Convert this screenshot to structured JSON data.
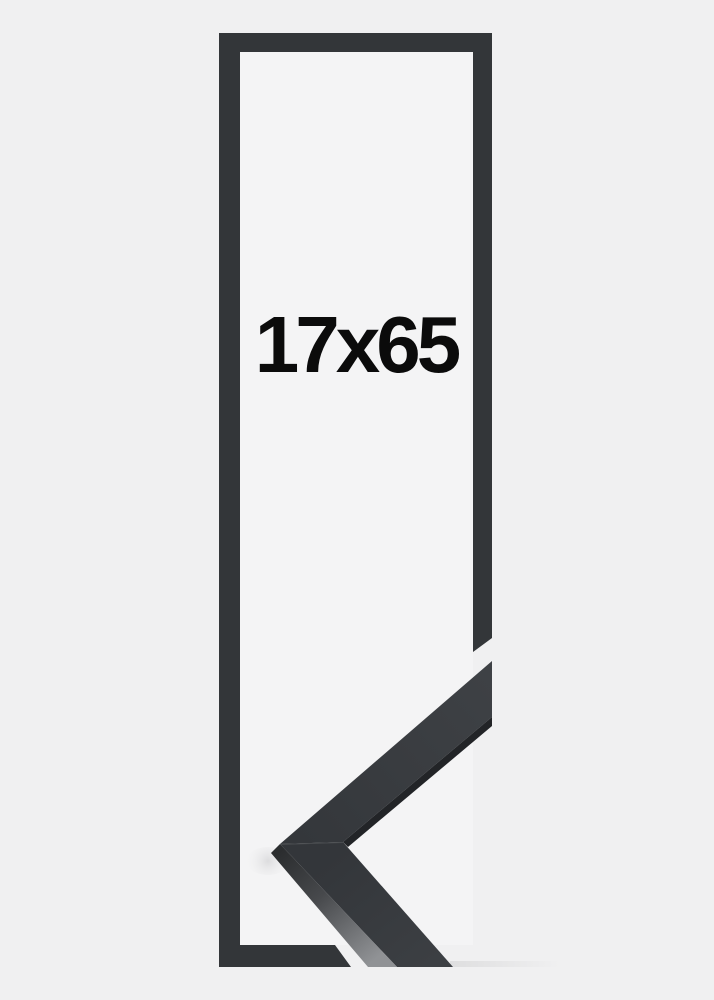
{
  "product": {
    "size_label": "17x65"
  },
  "image": {
    "kind": "picture-frame-product-photo",
    "elements": {
      "frame_outline": "tall rectangular frame outline drawing with mitre-cut gaps at lower right",
      "corner_sample": "photographic mitred corner sample of the black moulding profile, bottom right"
    }
  },
  "colors": {
    "background": "#f0f0f1",
    "inner_area": "#f4f4f5",
    "frame_outline": "#333639",
    "sample_face_dark": "#35383c",
    "sample_face_light": "#3e4145",
    "sample_edge": "#222427",
    "sample_side_highlight": "#909295",
    "label_text": "#0b0b0b"
  }
}
